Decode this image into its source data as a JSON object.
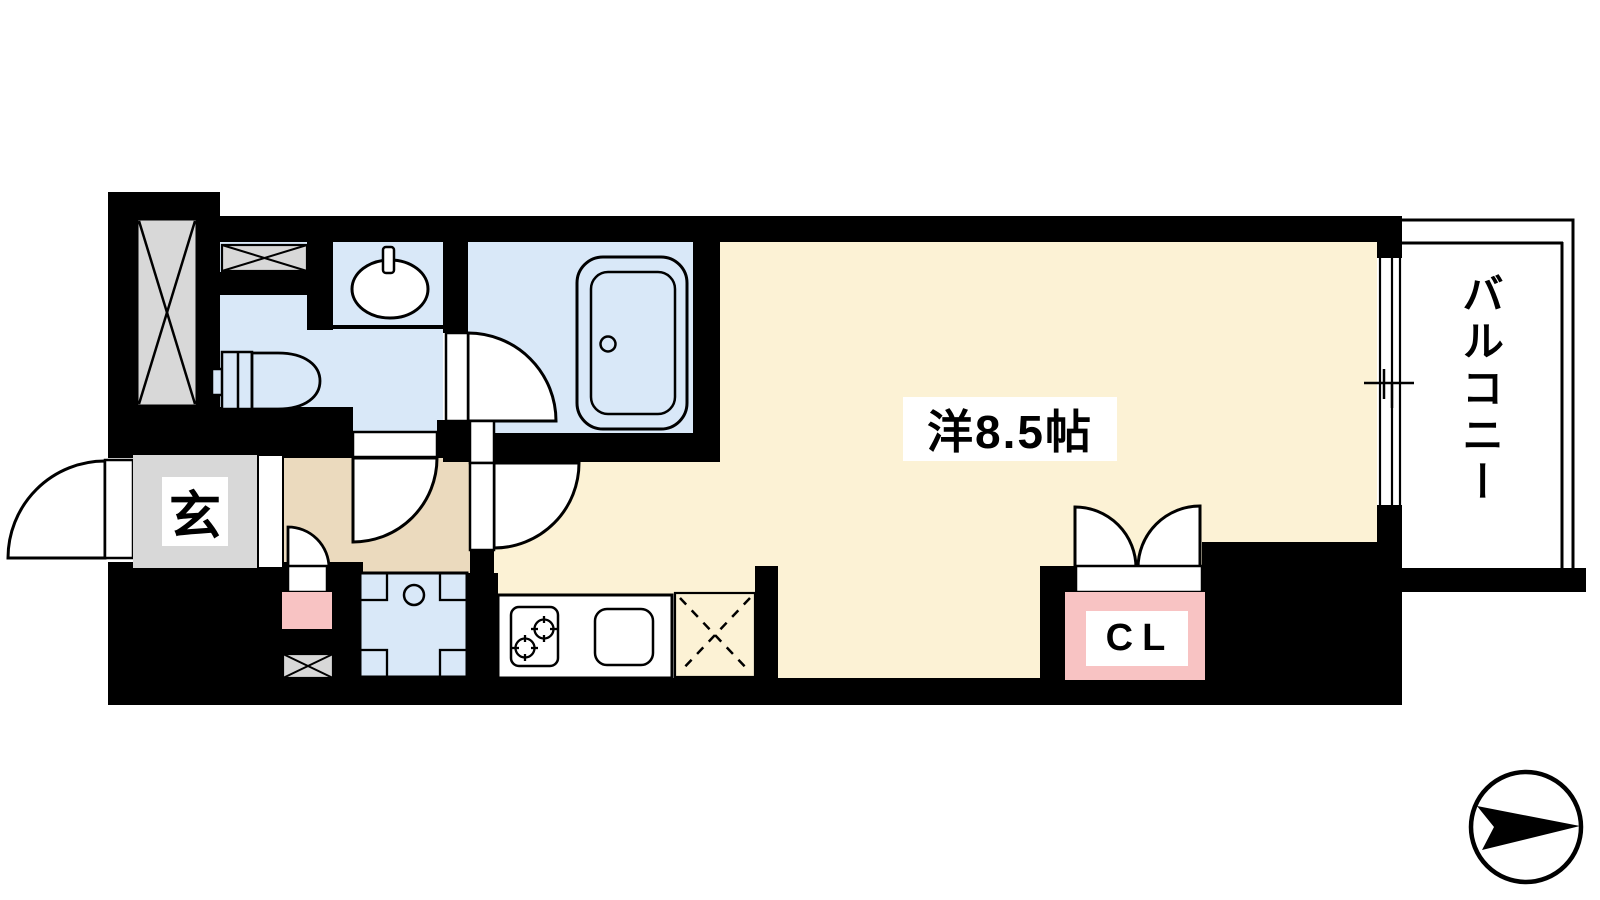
{
  "title": "apartment floor plan",
  "labels": {
    "main_room": "洋8.5帖",
    "balcony": "バルコニー",
    "entrance": "玄",
    "closet": "CL"
  },
  "colors": {
    "wall_black": "#000000",
    "room_cream": "#FCF2D5",
    "hallway_tan": "#EBDABE",
    "wet_area_blue": "#D9E8F8",
    "closet_pink": "#F8C3C3",
    "shaft_gray": "#D8D8D8",
    "line_black": "#000000"
  },
  "icons": {
    "compass": "north-arrow-icon",
    "shaft": "x-box-shaft-icon",
    "refrigerator_space": "dashed-x-icon"
  }
}
